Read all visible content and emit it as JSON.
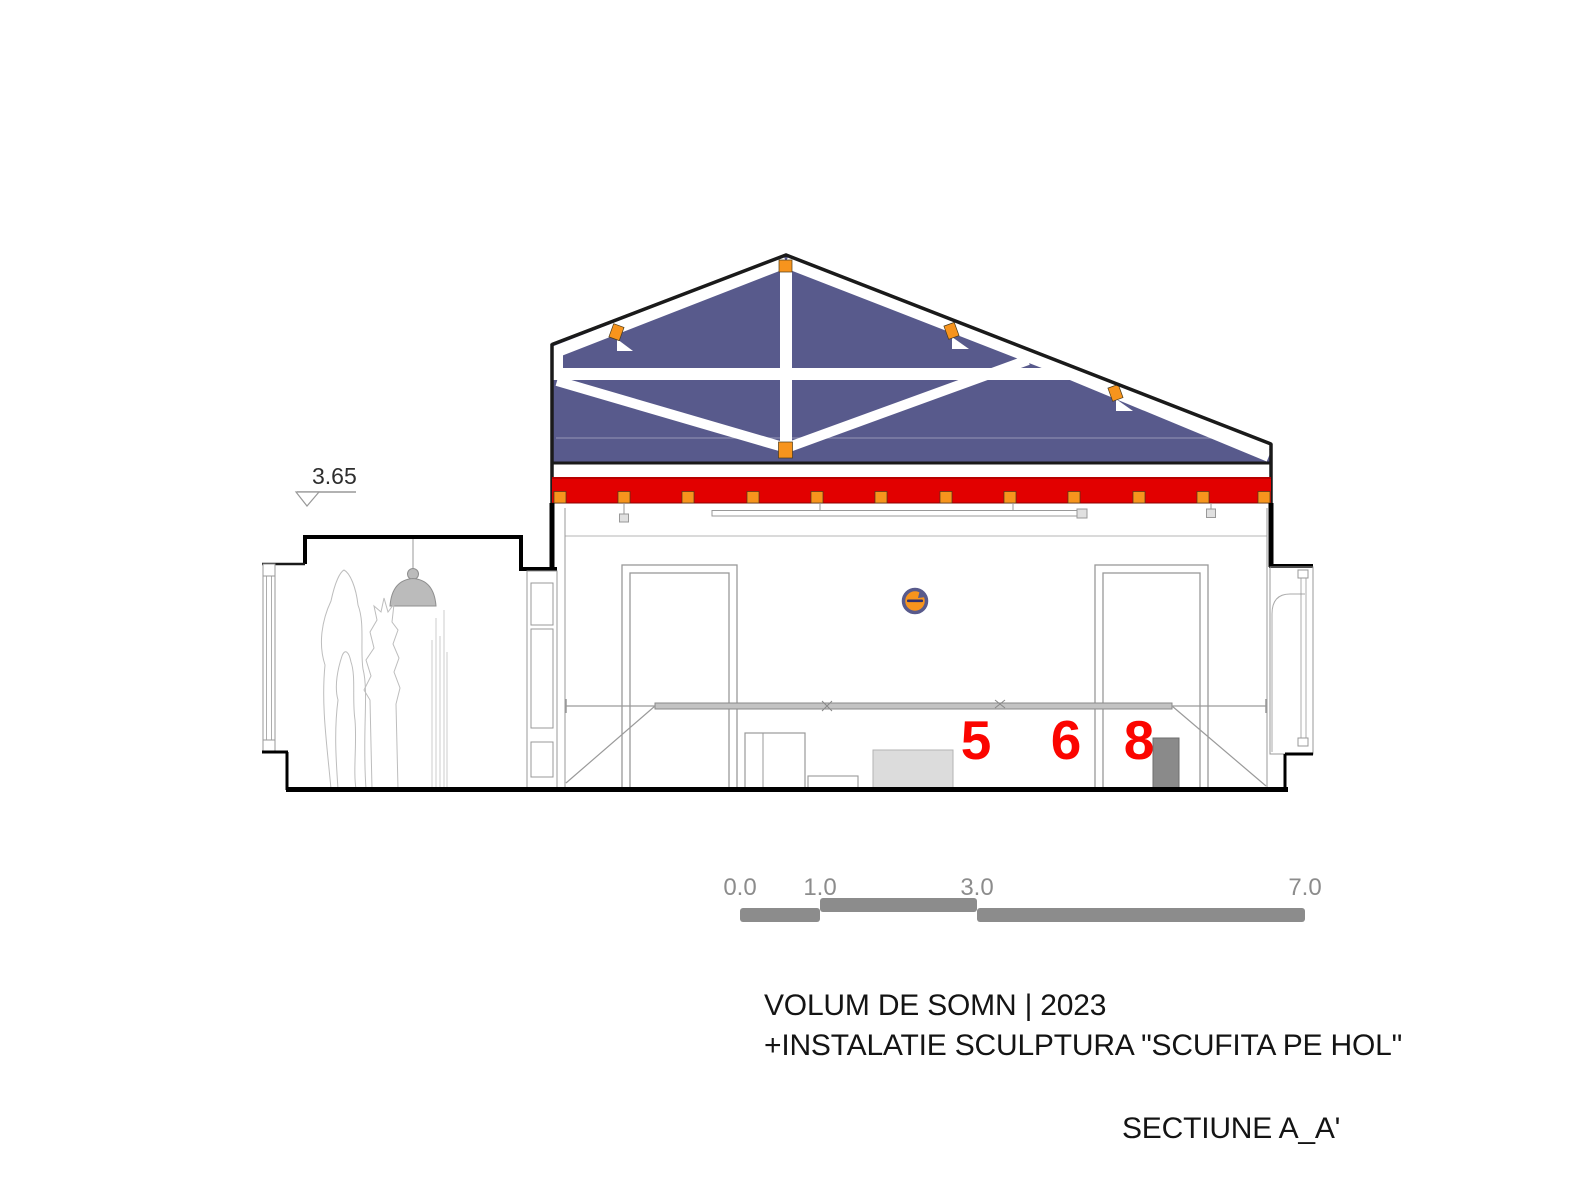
{
  "drawing": {
    "title_line1": "VOLUM DE SOMN | 2023",
    "title_line2": "+INSTALATIE SCULPTURA \"SCUFITA PE HOL\"",
    "section_label": "SECTIUNE A_A'",
    "level_marker": "3.65",
    "sculpture_numbers": [
      "5",
      "6",
      "8"
    ],
    "scale_labels": [
      "0.0",
      "1.0",
      "3.0",
      "7.0"
    ]
  },
  "colors": {
    "c-navy": "#585a8c",
    "c-orange": "#f7941d",
    "c-red": "#e20000",
    "c-red-text": "#fb0500",
    "c-ink": "#141414",
    "c-gray": "#8c8c8c",
    "c-line": "#999999"
  }
}
